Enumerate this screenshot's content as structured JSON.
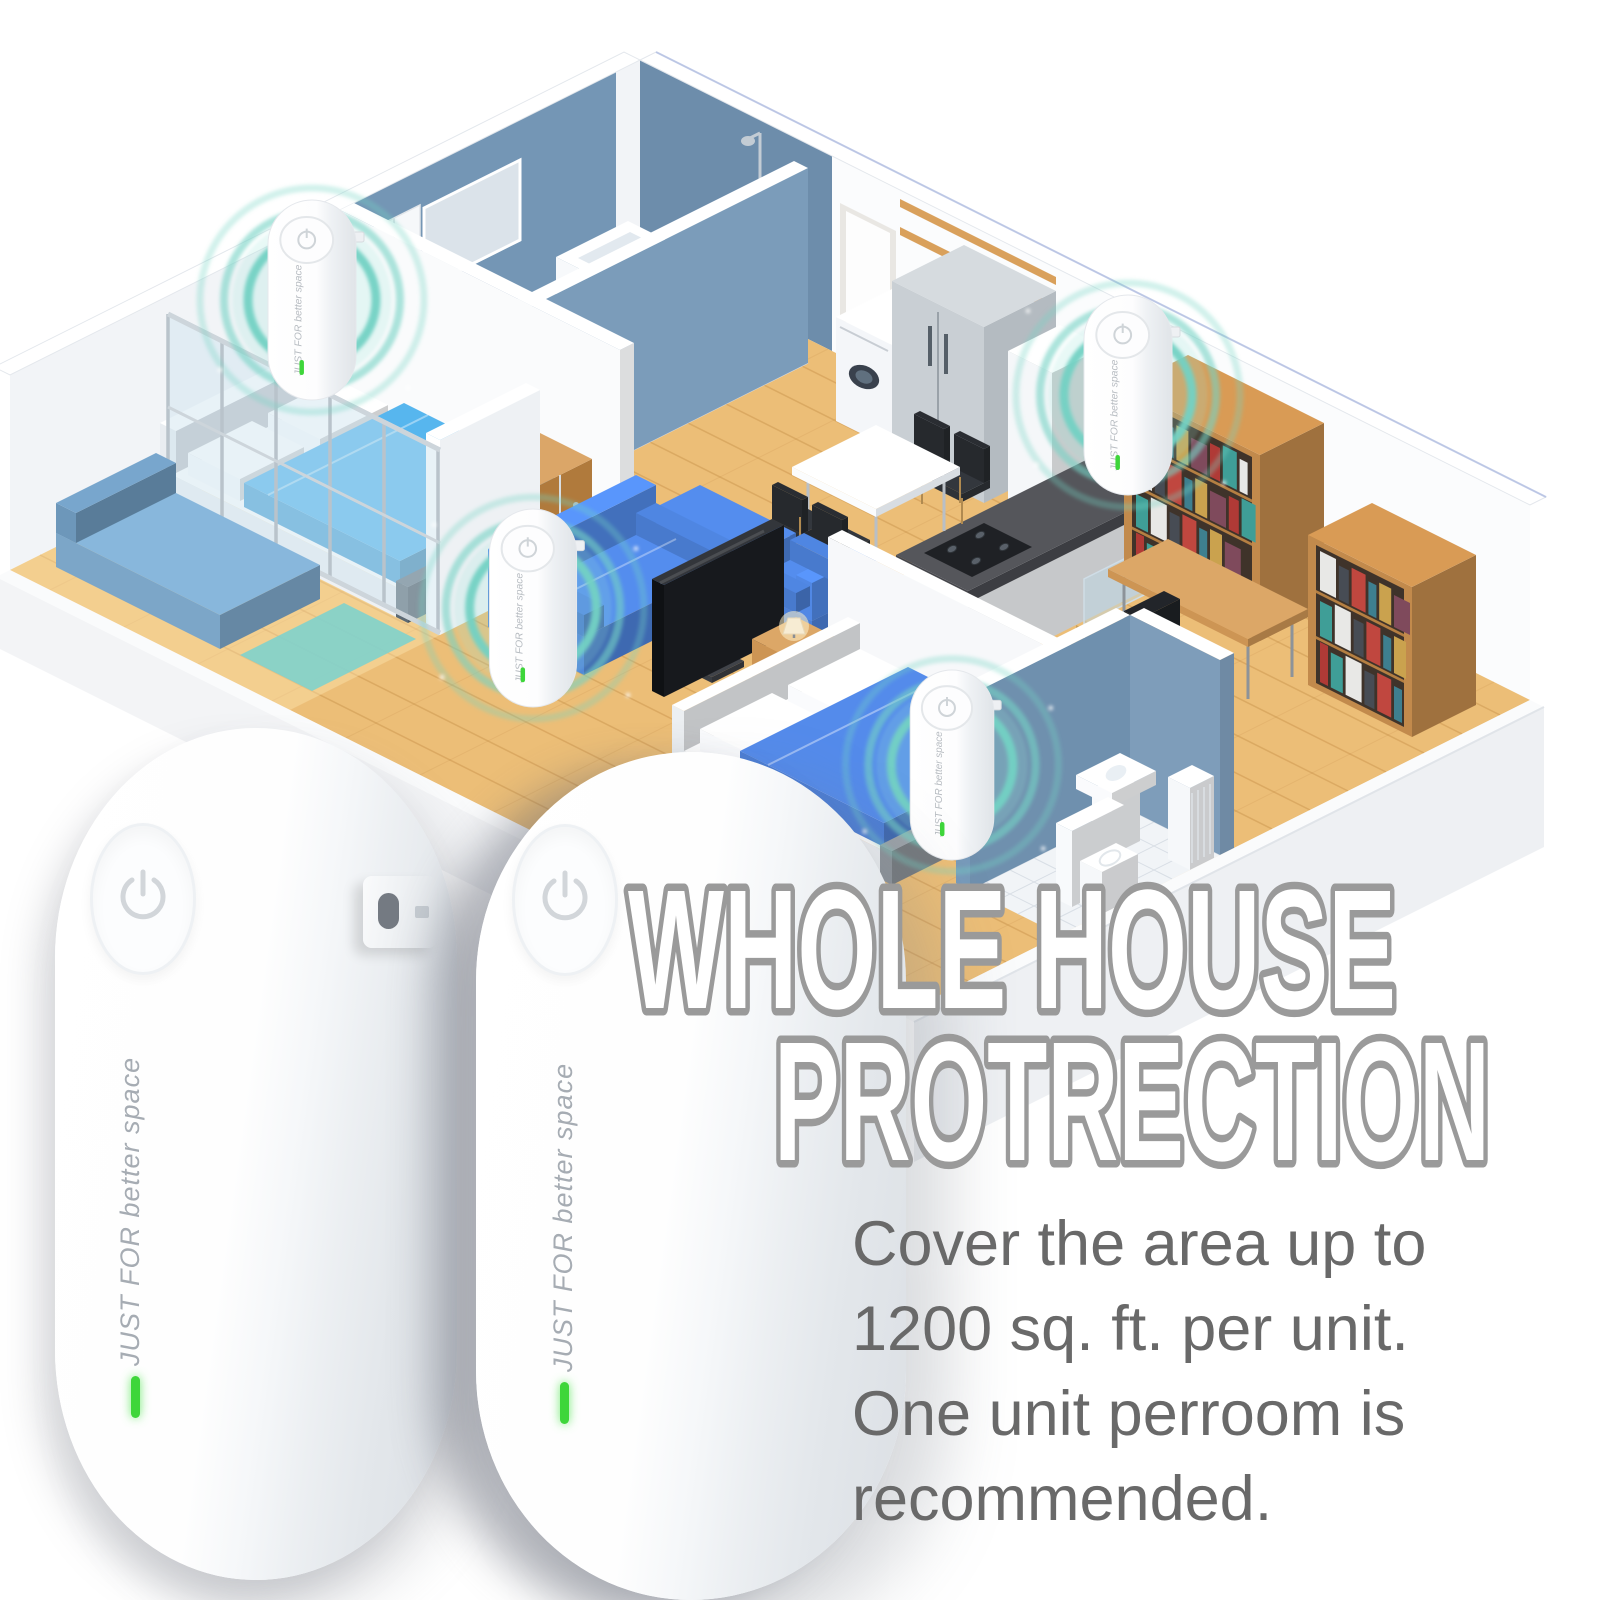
{
  "headline": {
    "line1": "WHOLE HOUSE",
    "line2": "PROTRECTION"
  },
  "body_text": {
    "lines": [
      "Cover the area up to",
      "1200 sq. ft. per unit.",
      "One unit perroom is",
      "recommended."
    ]
  },
  "product": {
    "label": "JUST FOR better space"
  },
  "colors": {
    "ripple_teal": "#74d2c4",
    "ripple_glow": "rgba(150,226,214,0.22)",
    "headline_fill": "#ffffff",
    "headline_outline": "#9a9a9a",
    "body_text": "#696969",
    "led_green": "#3ed63a",
    "wood_floor": "#ecbe77",
    "wall_blue": "#7496b5",
    "wall_blue_dark": "#6d8dab",
    "sofa_blue": "#4c80d8",
    "bed_teal": "#4fa5d8",
    "bed_blue": "#4c7ed6",
    "bookshelf_wood": "#c28a4c",
    "device_white": "#fbfbfc"
  }
}
